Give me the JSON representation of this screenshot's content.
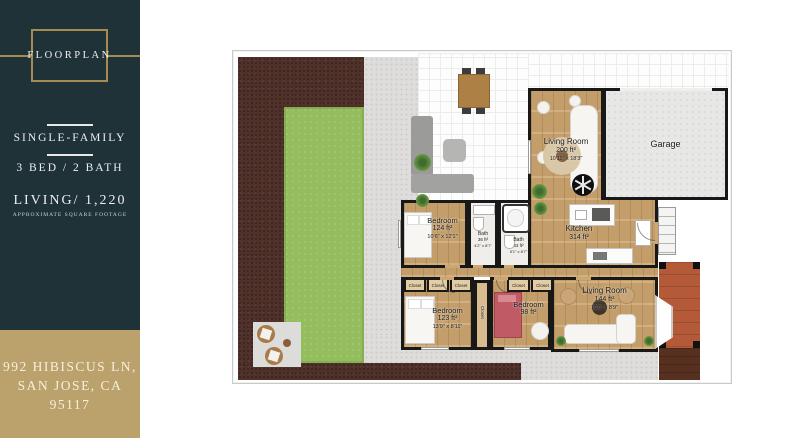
{
  "sidebar": {
    "badge": "FLOORPLAN",
    "property_type": "SINGLE-FAMILY",
    "beds_baths": "3 BED / 2 BATH",
    "living": "LIVING/ 1,220",
    "living_caption": "APPROXIMATE SQUARE FOOTAGE",
    "address_line1": "992 HIBISCUS LN,",
    "address_line2": "SAN JOSE, CA 95117"
  },
  "colors": {
    "sidebar_teal": "#1f3238",
    "gold_accent": "#a88b50",
    "address_gold": "#bba26c",
    "lawn_green": "#94bd5e",
    "soil_brown": "#50312a",
    "porch_terracotta": "#b45a38",
    "wood_floor": "#cda771"
  },
  "floorplan": {
    "closet_label": "Closet",
    "rooms": [
      {
        "name": "Living Room",
        "area": "200 ft²",
        "dims": "10'11\" x 18'3\""
      },
      {
        "name": "Garage"
      },
      {
        "name": "Kitchen",
        "area": "314 ft²"
      },
      {
        "name": "Bedroom",
        "area": "124 ft²",
        "dims": "10'6\" x 12'1\""
      },
      {
        "name": "Bath",
        "area": "36 ft²",
        "dims": "4'2\" x 8'7\""
      },
      {
        "name": "Bath",
        "area": "43 ft²",
        "dims": "5'1\" x 8'7\""
      },
      {
        "name": "Bedroom",
        "area": "123 ft²",
        "dims": "13'9\" x 8'11\""
      },
      {
        "name": "Bedroom",
        "area": "98 ft²"
      },
      {
        "name": "Living Room",
        "area": "144 ft²",
        "dims": "16'6\" x 8'9\""
      }
    ]
  }
}
